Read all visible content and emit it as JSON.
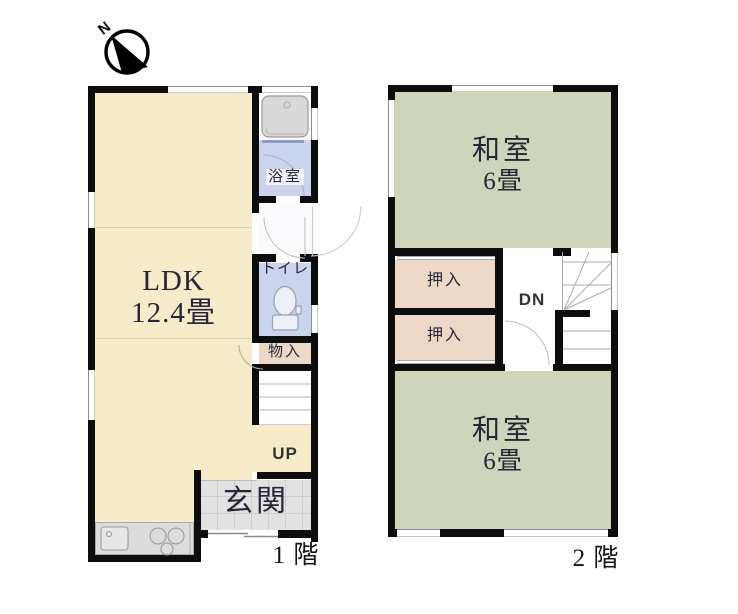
{
  "plan": {
    "compass": {
      "label": "N"
    },
    "floor1": {
      "caption": "1 階",
      "ldk": {
        "name": "LDK",
        "size": "12.4畳"
      },
      "bath": {
        "name": "浴室"
      },
      "toilet": {
        "name": "トイレ"
      },
      "storage": {
        "name": "物入"
      },
      "entrance": {
        "name": "玄関"
      },
      "stairs": {
        "label": "UP"
      }
    },
    "floor2": {
      "caption": "2 階",
      "japanese_room_north": {
        "name": "和室",
        "size": "6畳"
      },
      "japanese_room_south": {
        "name": "和室",
        "size": "6畳"
      },
      "closet_north": {
        "name": "押入"
      },
      "closet_south": {
        "name": "押入"
      },
      "stairs": {
        "label": "DN"
      }
    },
    "colors": {
      "ldk_floor": "#f6ecca",
      "tatami_floor": "#cfd5ba",
      "closet_floor": "#eed9c8",
      "wet_area_floor": "#cbd4ed",
      "entrance_floor": "#e2e2e2",
      "counter": "#dcdcdc",
      "wall": "#0d0d0d"
    }
  }
}
